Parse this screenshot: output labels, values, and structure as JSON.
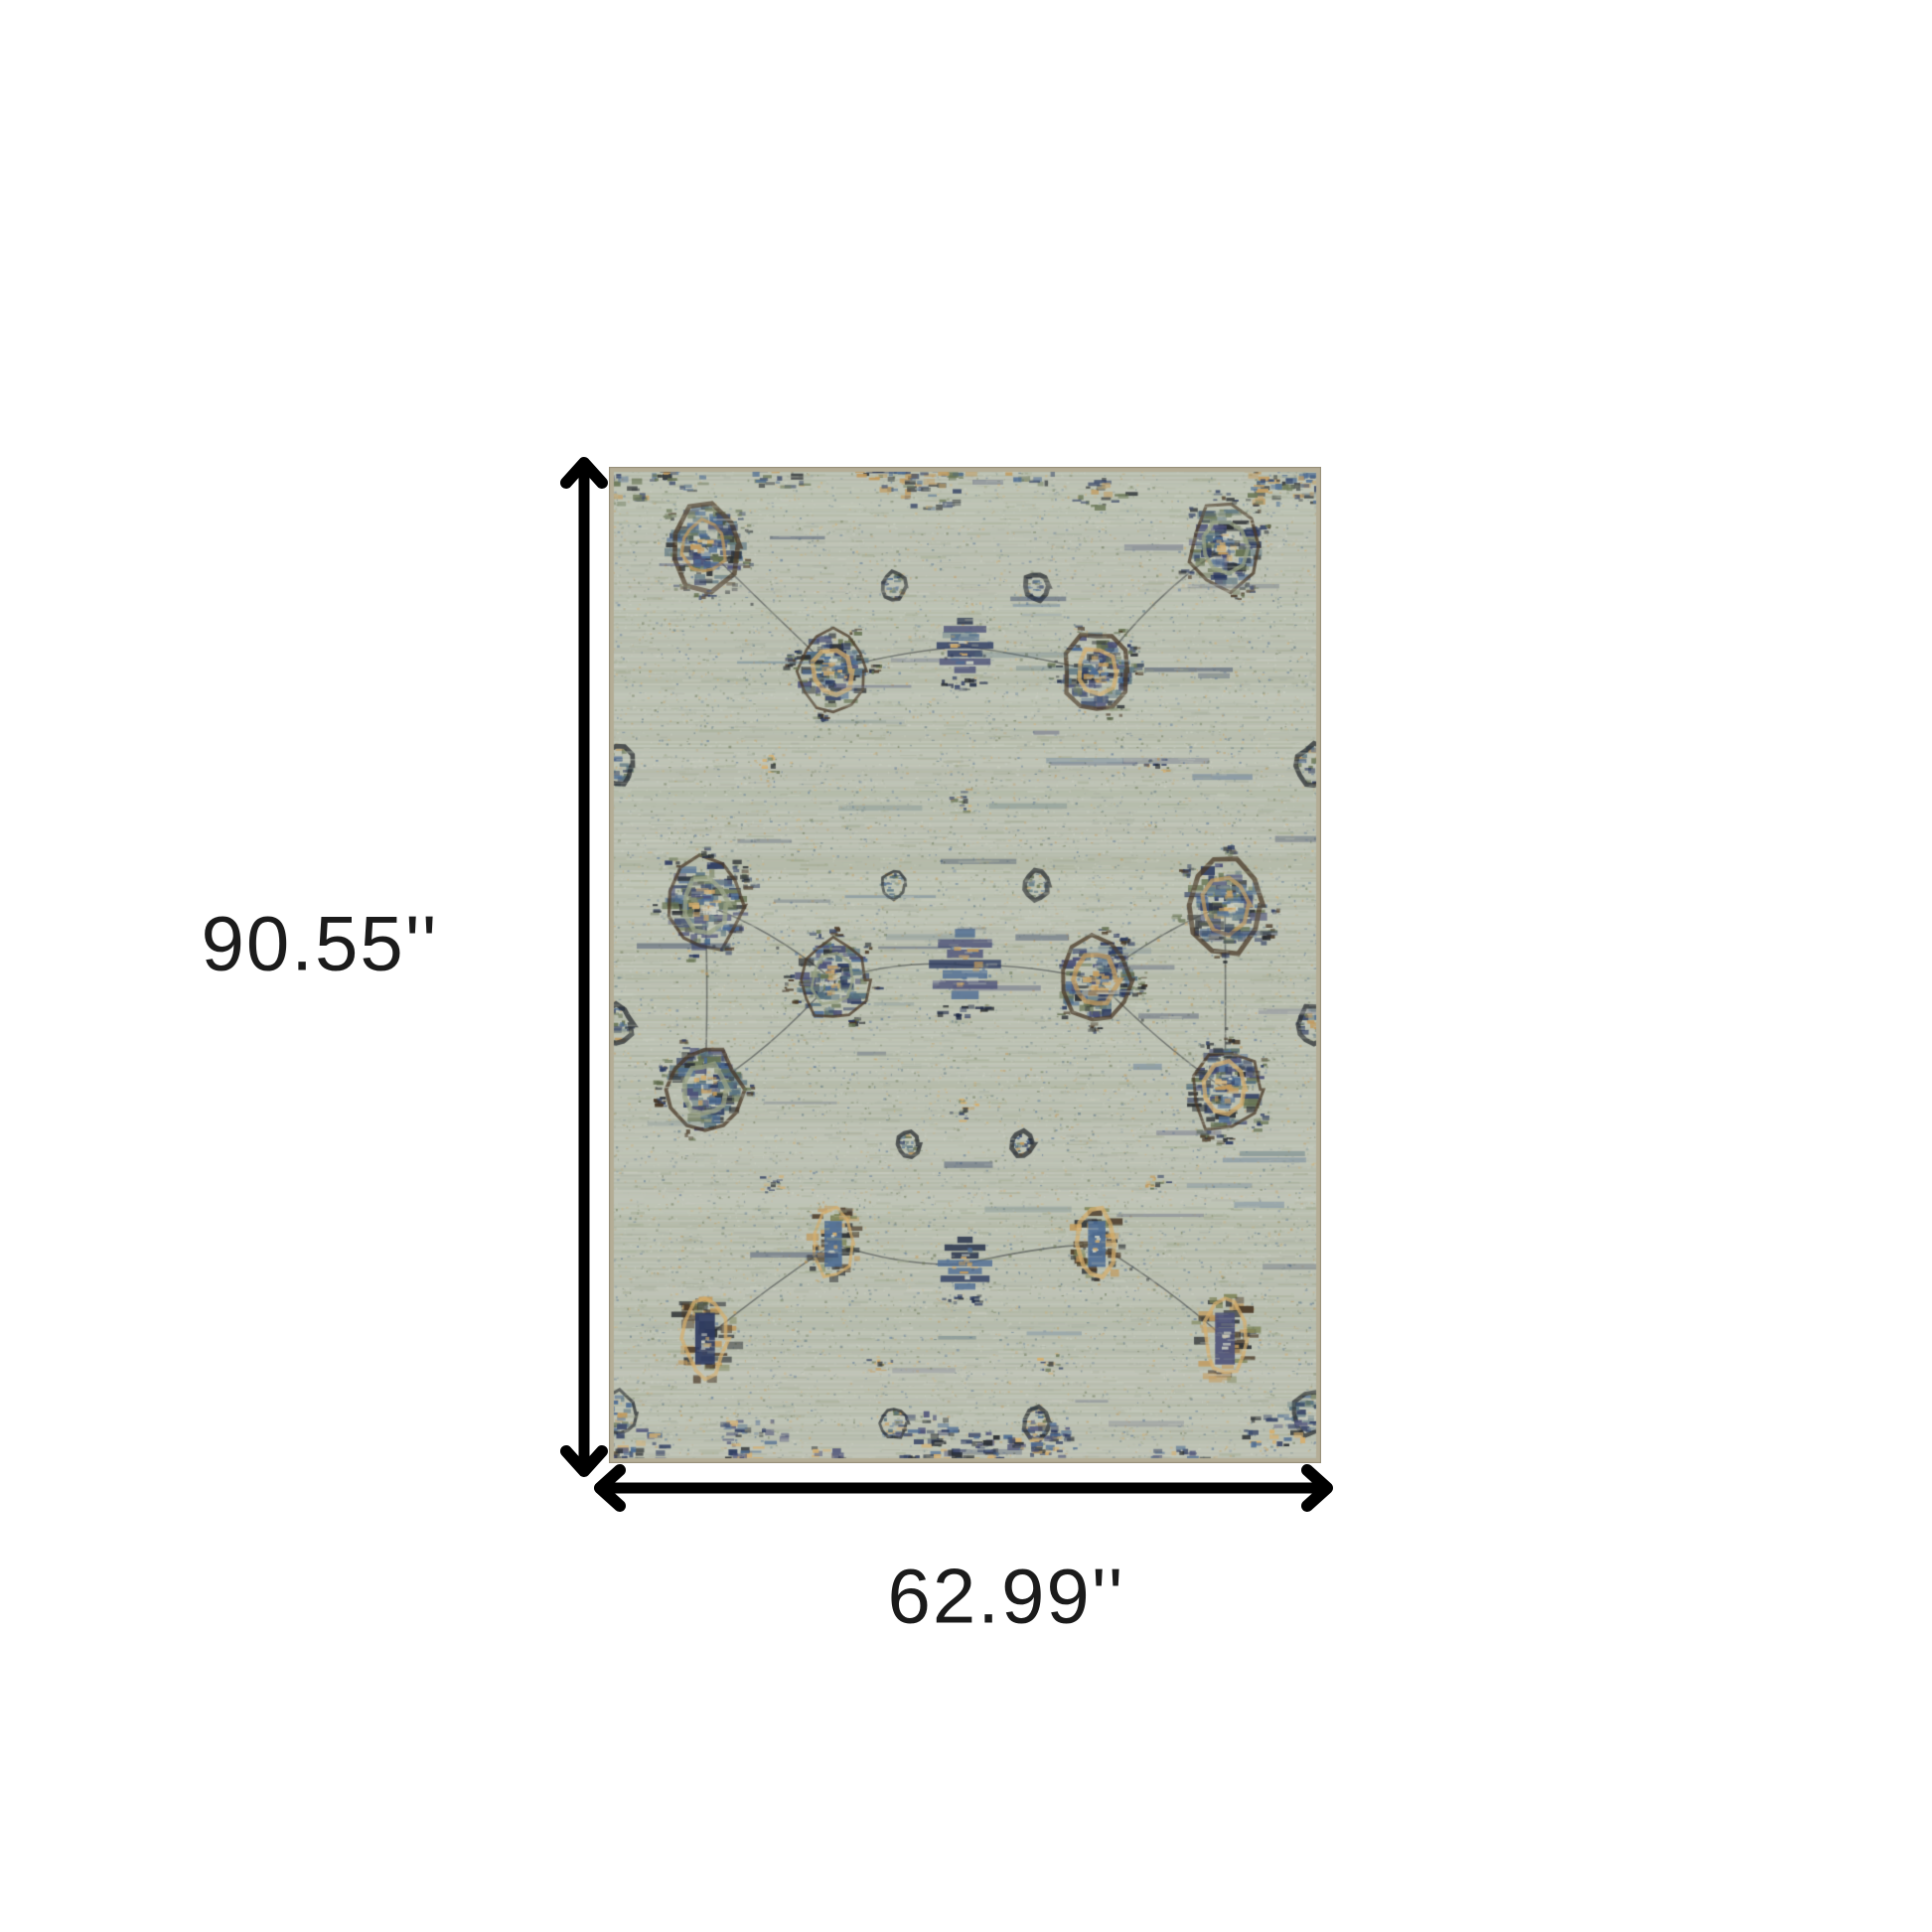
{
  "figure": {
    "kind": "product-dimension-diagram",
    "product": "distressed oriental area rug",
    "height_label": "90.55''",
    "width_label": "62.99''"
  },
  "style": {
    "background": "#ffffff",
    "arrow_color": "#000000",
    "label_color": "#1b1b1b",
    "rug_palette": {
      "base": "#bcc1b3",
      "base_light": "#ccd0c4",
      "base_dark": "#a4ab9c",
      "sage": "#9aa386",
      "navy": "#2c3a60",
      "navy_dark": "#1f2a46",
      "indigo": "#4c5178",
      "blue": "#4d6c93",
      "teal": "#55707e",
      "green": "#667352",
      "olive": "#7d8457",
      "tan": "#c29a5d",
      "gold": "#d6af6e",
      "brown": "#4b3a28",
      "dark": "#2b2f33",
      "edge": "#b4ad96"
    }
  }
}
